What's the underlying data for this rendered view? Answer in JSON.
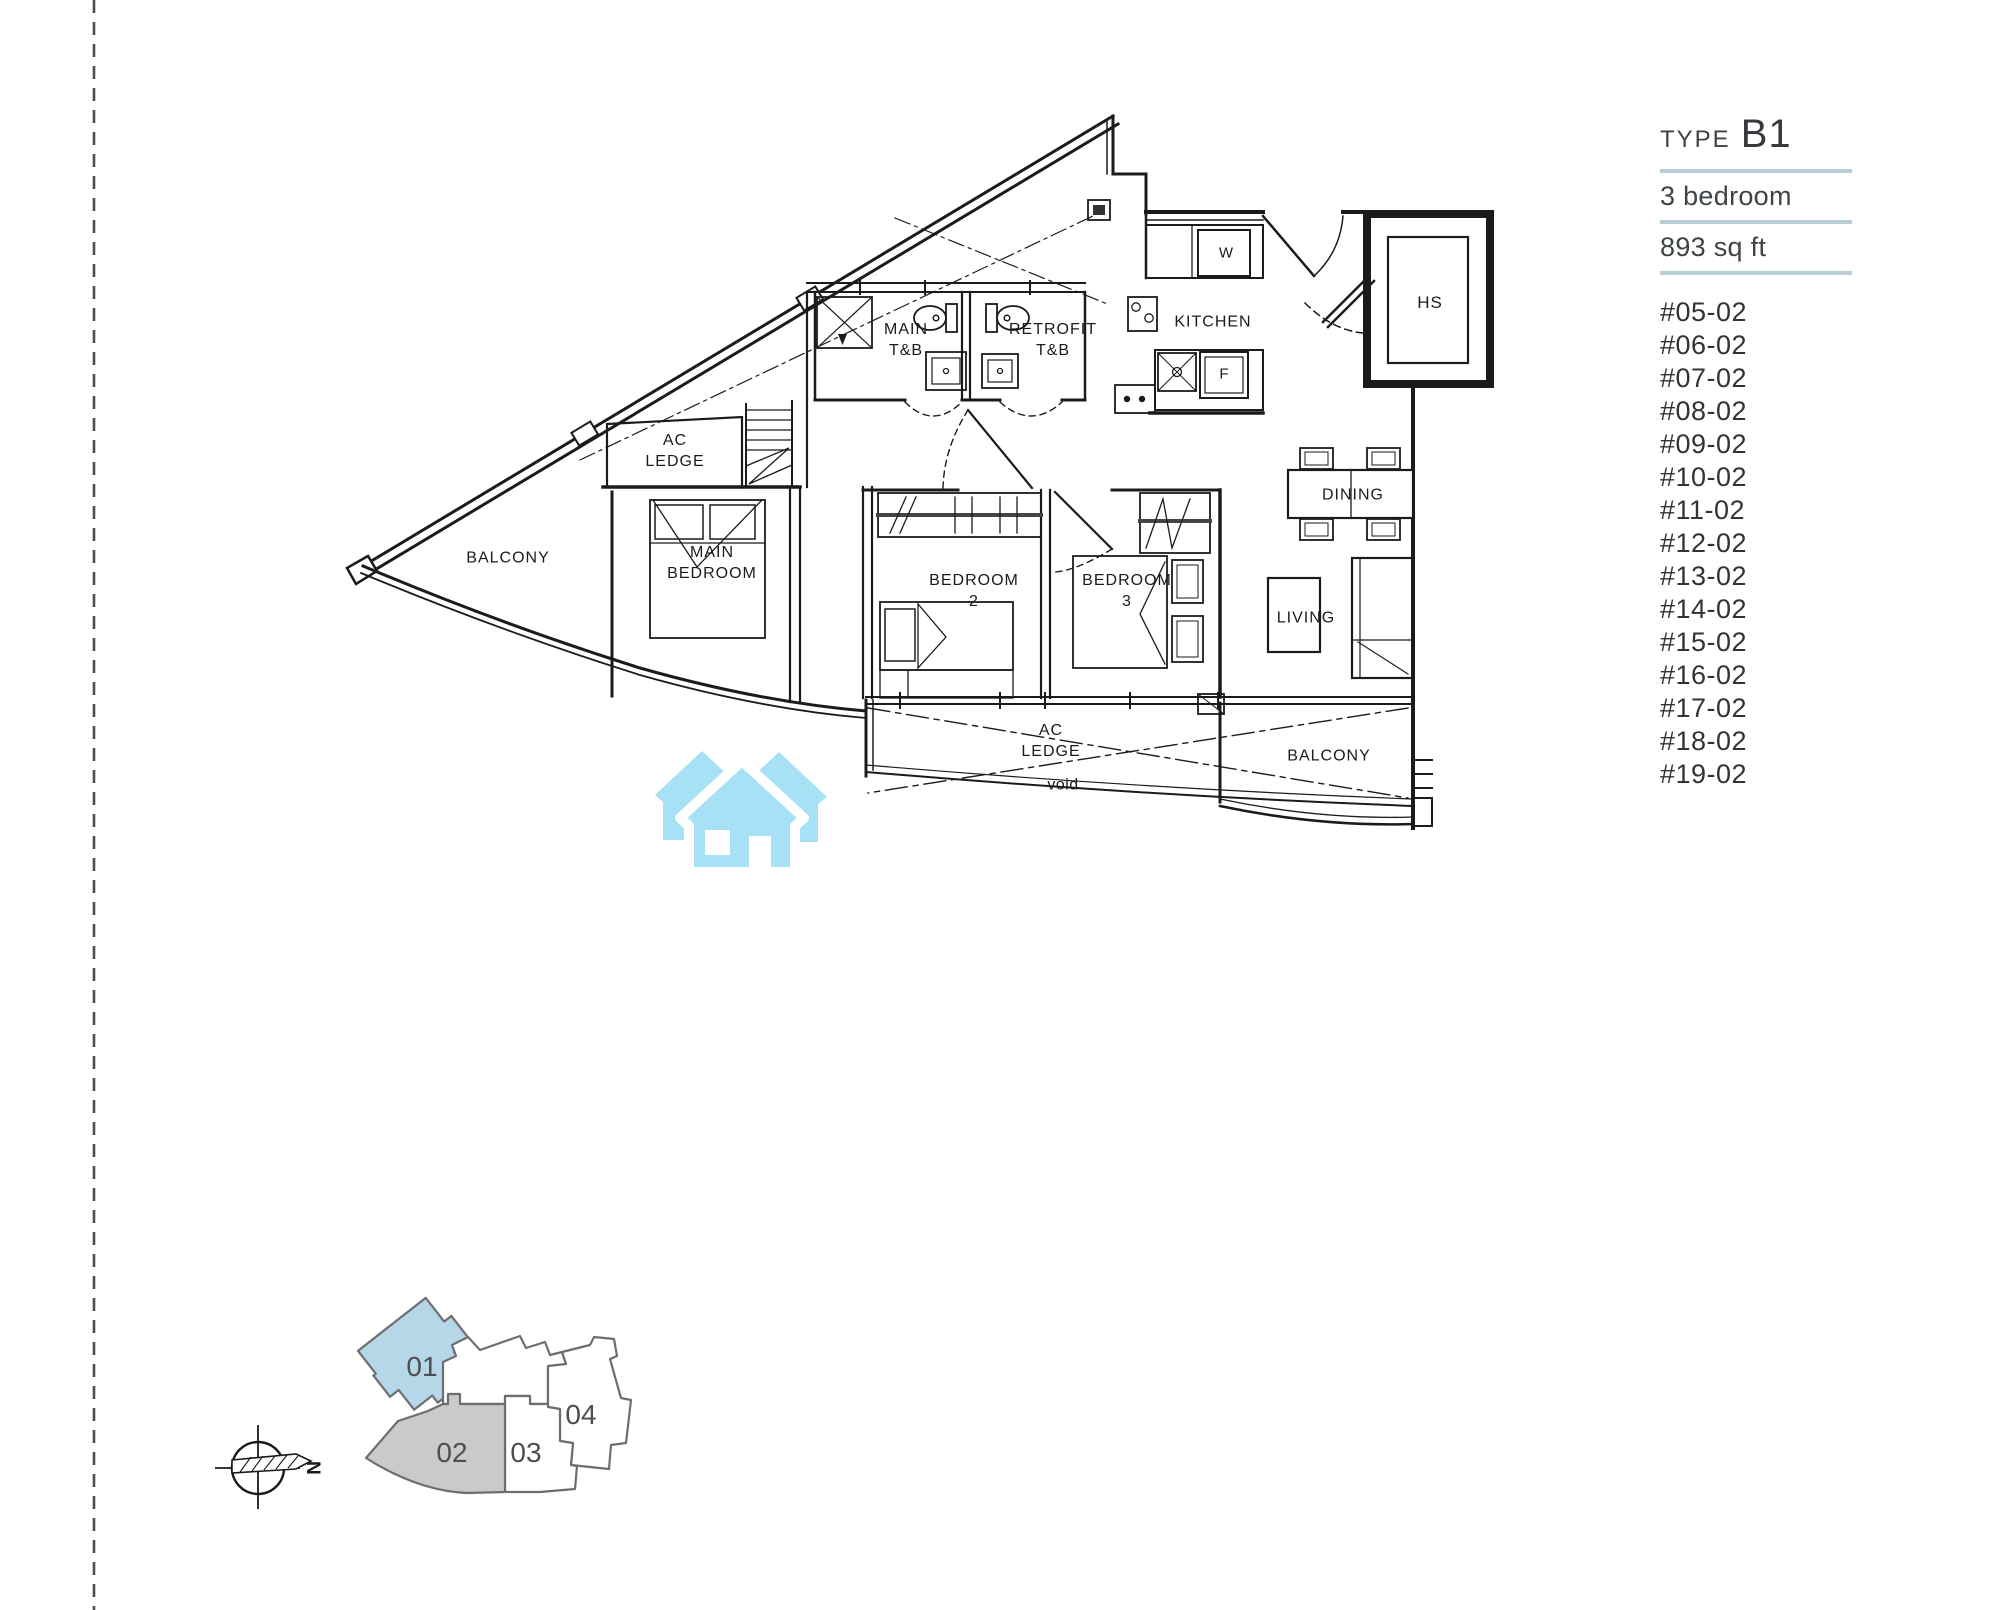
{
  "page": {
    "background": "#ffffff"
  },
  "info_panel": {
    "type_label": "TYPE",
    "type_value": "B1",
    "specs": {
      "bedrooms": "3 bedroom",
      "area": "893 sq ft"
    },
    "divider_color": "#b9cdd6",
    "units": [
      "#05-02",
      "#06-02",
      "#07-02",
      "#08-02",
      "#09-02",
      "#10-02",
      "#11-02",
      "#12-02",
      "#13-02",
      "#14-02",
      "#15-02",
      "#16-02",
      "#17-02",
      "#18-02",
      "#19-02"
    ]
  },
  "floor_plan": {
    "labels": {
      "balcony_left": "BALCONY",
      "ac_ledge_top": "AC\nLEDGE",
      "main_bedroom": "MAIN\nBEDROOM",
      "main_tb": "MAIN\nT&B",
      "retrofit_tb": "RETROFIT\nT&B",
      "kitchen": "KITCHEN",
      "washer": "W",
      "fridge": "F",
      "hs": "HS",
      "dining": "DINING",
      "living": "LIVING",
      "bedroom2": "BEDROOM\n2",
      "bedroom3": "BEDROOM\n3",
      "ac_ledge_bottom": "AC\nLEDGE",
      "void": "void",
      "balcony_bottom": "BALCONY"
    }
  },
  "key_plan": {
    "units": [
      {
        "label": "01",
        "fill": "#b5d7e8",
        "highlighted": true
      },
      {
        "label": "02",
        "fill": "#c9cacc",
        "highlighted": false
      },
      {
        "label": "03",
        "fill": "#ffffff",
        "highlighted": false
      },
      {
        "label": "04",
        "fill": "#ffffff",
        "highlighted": false
      }
    ],
    "outline_color": "#6d6e71",
    "compass_north": "N"
  },
  "logo": {
    "house_color": "#a6e1f6"
  }
}
